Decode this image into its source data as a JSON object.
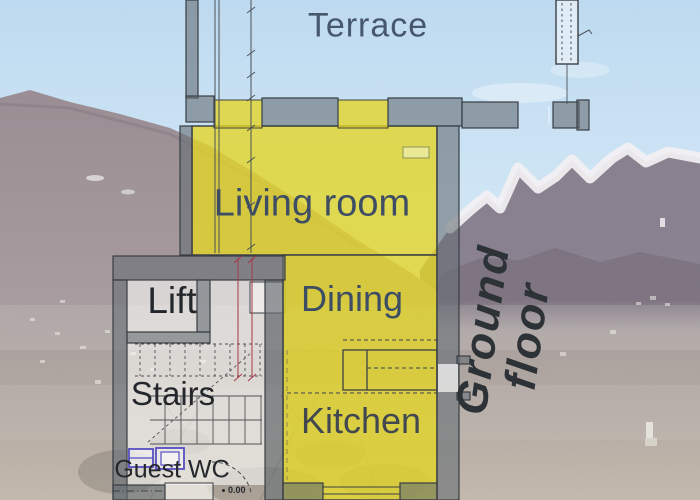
{
  "scene": {
    "kind": "ground-floor plan overlaid on alpine valley photo",
    "photo_colors": {
      "sky": "#c9e1f3",
      "mountain_left": "#978b91",
      "mountain_snowy_rock": "#8a8190",
      "snow": "#f3f1f3",
      "valley_haze": "#b3a9a2"
    }
  },
  "floorplan": {
    "rooms": {
      "terrace": "Terrace",
      "living_room": "Living room",
      "dining": "Dining",
      "kitchen": "Kitchen",
      "lift": "Lift",
      "stairs": "Stairs",
      "guest_wc": "Guest WC"
    },
    "floor_label_line1": "Ground",
    "floor_label_line2": "floor",
    "level_marker": "0.00",
    "colors": {
      "room_highlight": "#e2d528",
      "wall": "#6a727a",
      "label_blue": "#3d4d63",
      "label_dark": "#24282c",
      "dimension_red": "#a83848",
      "fixture_blue": "#564fc2"
    }
  }
}
